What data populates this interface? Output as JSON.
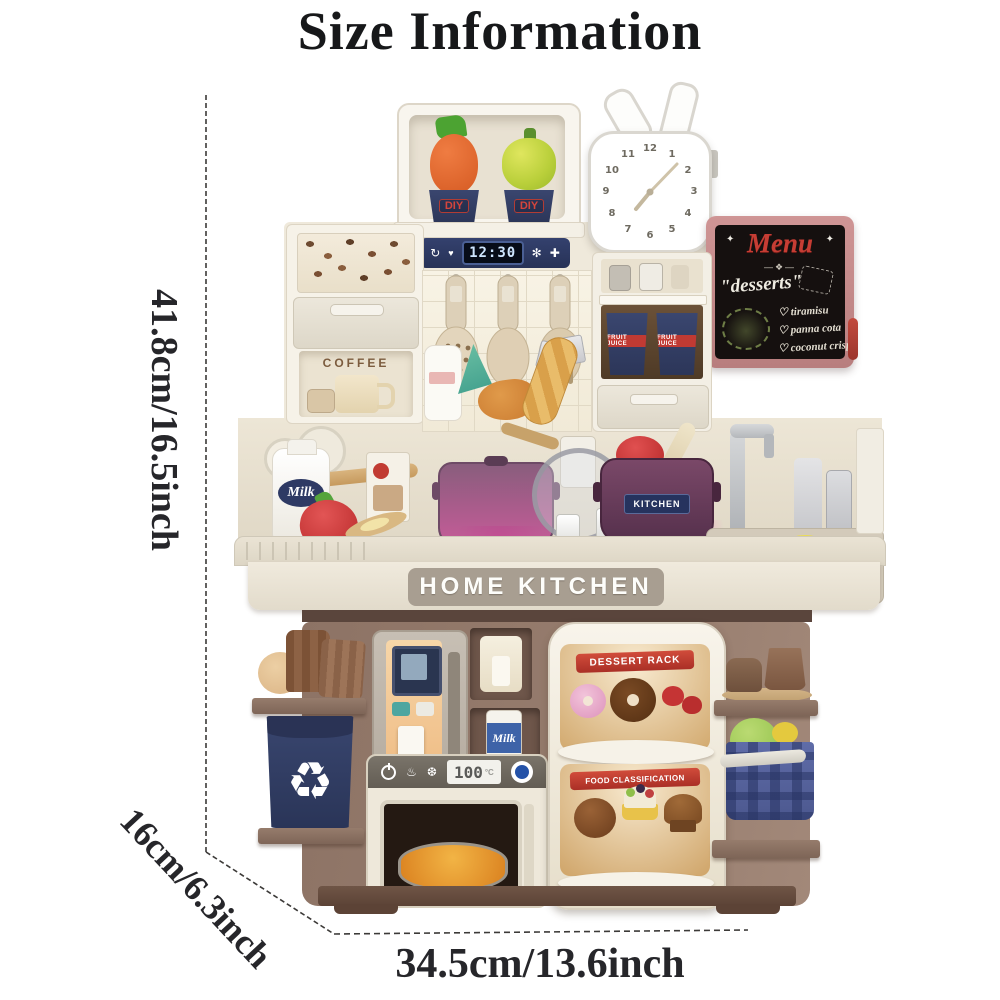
{
  "title": "Size Information",
  "dimensions": {
    "height": "41.8cm/16.5inch",
    "depth": "16cm/6.3inch",
    "width": "34.5cm/13.6inch"
  },
  "toy": {
    "diy_shelf": {
      "cup1": "DIY",
      "cup2": "DIY"
    },
    "control_panel": {
      "time": "12:30",
      "icons": {
        "rotate": "↻",
        "drop": "♥",
        "fan": "✻",
        "plus": "✚"
      }
    },
    "clock": {
      "numbers": [
        "12",
        "1",
        "2",
        "3",
        "4",
        "5",
        "6",
        "7",
        "8",
        "9",
        "10",
        "11"
      ]
    },
    "menu_board": {
      "title": "Menu",
      "deco_left": "✦",
      "deco_right": "✦",
      "divider": "—❖—",
      "subtitle": "\"desserts\"",
      "bullet": "♡",
      "items": [
        "tiramisu",
        "panna cota",
        "coconut crisp"
      ]
    },
    "coffee_station": {
      "label": "COFFEE"
    },
    "fruit_juice": {
      "label": "FRUIT JUICE"
    },
    "milk_jug": {
      "label": "Milk"
    },
    "kitchen_pot": {
      "label": "KITCHEN"
    },
    "counter_banner": {
      "label": "HOME KITCHEN"
    },
    "milk_can": {
      "label": "Milk"
    },
    "microwave": {
      "display": "100",
      "unit": "°C",
      "icons": {
        "steam": "♨",
        "snow": "❆"
      }
    },
    "dessert_rack": {
      "top_label": "DESSERT RACK",
      "bottom_label": "FOOD CLASSIFICATION"
    },
    "recycle_icon": "♻"
  }
}
